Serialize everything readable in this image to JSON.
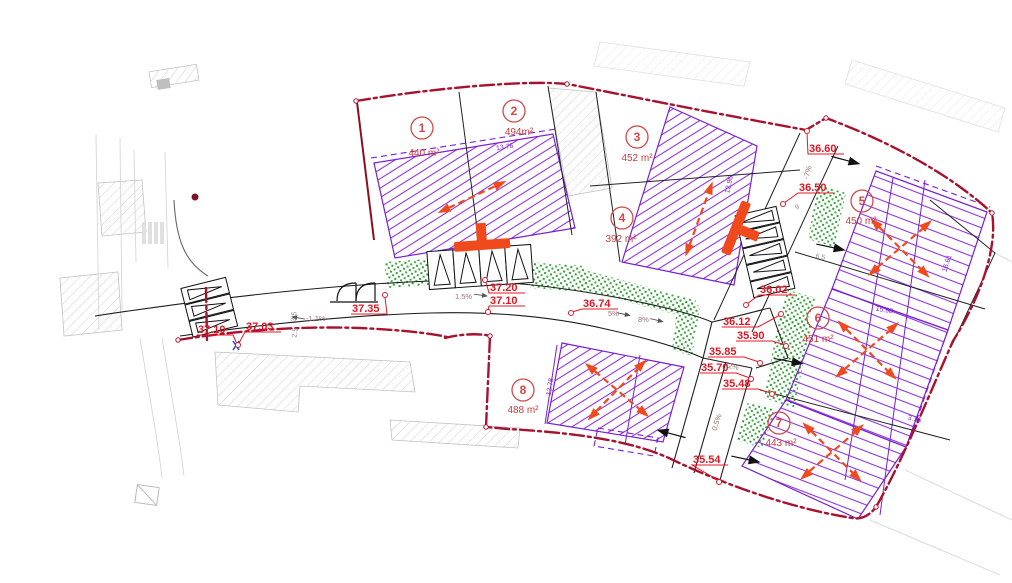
{
  "plan": {
    "lots": [
      {
        "number": "1",
        "area": "440 m²"
      },
      {
        "number": "2",
        "area": "494m²"
      },
      {
        "number": "3",
        "area": "452 m²"
      },
      {
        "number": "4",
        "area": "392 m²"
      },
      {
        "number": "5",
        "area": "450 m²"
      },
      {
        "number": "6",
        "area": "451 m²"
      },
      {
        "number": "7",
        "area": "443 m²"
      },
      {
        "number": "8",
        "area": "488 m²"
      }
    ],
    "spot_elevations": [
      "37.10",
      "37.03",
      "37.35",
      "37.20",
      "37.10",
      "36.74",
      "36.60",
      "36.50",
      "36.02",
      "36.12",
      "35.90",
      "35.85",
      "35.70",
      "35.48",
      "35.54"
    ],
    "slopes": [
      "-1.1%",
      "1.5%",
      "5%",
      "8%",
      "-7%",
      "2%",
      "0.5%"
    ],
    "dimensions": [
      "13.76",
      "12.96",
      "16.61",
      "15.98",
      "3.16",
      "12.78",
      "3.5",
      "2.5",
      "9",
      "6.5"
    ],
    "colors": {
      "boundary_red": "#a8122e",
      "elevation_label_red": "#e01825",
      "lot_label_red": "#d24848",
      "envelope_purple": "#7a1fd1",
      "hatch_purple": "#8d35e0",
      "landscaping_green": "#2fa133",
      "symbol_orange": "#f04a1c",
      "road_black": "#1d1d1d",
      "existing_gray": "#d0d0d0"
    }
  }
}
